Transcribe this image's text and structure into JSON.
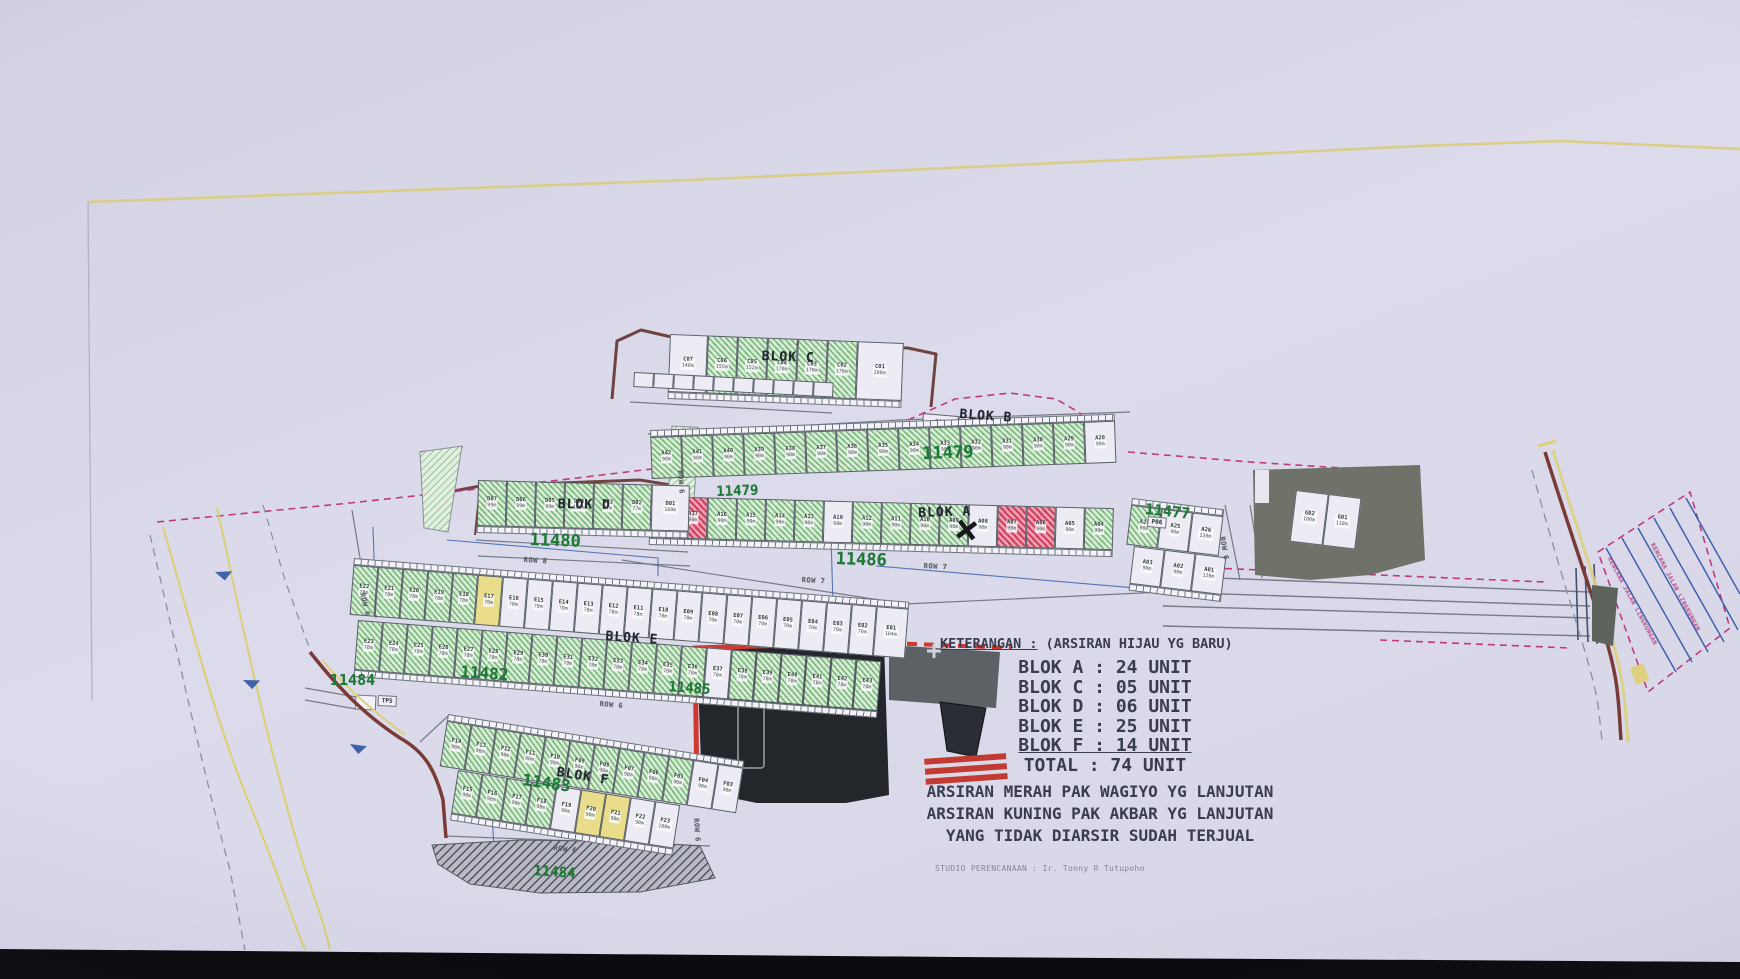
{
  "photo": {
    "paper_color": "#d8d7e8",
    "bottom_bar_color": "#0b0b0e",
    "yellow_line_color": "#d9cd7d",
    "green_hatch_color": "#79b97c",
    "red_hatch_color": "#cf4260",
    "yellow_unit_color": "#e9dd8b",
    "parcel_number_color": "#1c7c35",
    "boundary_magenta": "#c03a80",
    "road_brown": "#7a3b36",
    "blue_line": "#3f63aa",
    "gray_area": "#5e635c"
  },
  "legend": {
    "title_label": "KETERANGAN :",
    "title_note": " (ARSIRAN HIJAU YG BARU)",
    "rows": [
      {
        "label": "BLOK A",
        "value": "24 UNIT",
        "underline": false
      },
      {
        "label": "BLOK C",
        "value": "05 UNIT",
        "underline": false
      },
      {
        "label": "BLOK D",
        "value": "06 UNIT",
        "underline": false
      },
      {
        "label": "BLOK E",
        "value": "25 UNIT",
        "underline": false
      },
      {
        "label": "BLOK F",
        "value": "14 UNIT",
        "underline": true
      },
      {
        "label": "TOTAL",
        "value": "74 UNIT",
        "underline": false
      }
    ],
    "notes": [
      "ARSIRAN MERAH PAK WAGIYO YG LANJUTAN",
      "ARSIRAN KUNING PAK AKBAR YG LANJUTAN",
      "YANG TIDAK DIARSIR SUDAH TERJUAL"
    ],
    "credit": "STUDIO PERENCANAAN : Ir. Tonny R Tutupoho"
  },
  "labels": [
    {
      "text": "11479",
      "x": 922,
      "y": 444,
      "size": 17,
      "rot": -2,
      "cls": "parcel"
    },
    {
      "text": "11479",
      "x": 716,
      "y": 484,
      "size": 14,
      "rot": -2,
      "cls": "parcel"
    },
    {
      "text": "11477",
      "x": 1146,
      "y": 500,
      "size": 15,
      "rot": 6,
      "cls": "parcel"
    },
    {
      "text": "11480",
      "x": 530,
      "y": 530,
      "size": 17,
      "rot": 2,
      "cls": "parcel"
    },
    {
      "text": "11486",
      "x": 836,
      "y": 549,
      "size": 17,
      "rot": 2,
      "cls": "parcel"
    },
    {
      "text": "11482",
      "x": 461,
      "y": 662,
      "size": 16,
      "rot": 4,
      "cls": "parcel"
    },
    {
      "text": "11485",
      "x": 669,
      "y": 679,
      "size": 14,
      "rot": 4,
      "cls": "parcel"
    },
    {
      "text": "11484",
      "x": 330,
      "y": 671,
      "size": 15,
      "rot": 0,
      "cls": "parcel"
    },
    {
      "text": "11483",
      "x": 524,
      "y": 770,
      "size": 16,
      "rot": 8,
      "cls": "parcel"
    },
    {
      "text": "11484",
      "x": 534,
      "y": 863,
      "size": 14,
      "rot": 4,
      "cls": "parcel"
    },
    {
      "text": "BLOK C",
      "x": 762,
      "y": 349,
      "size": 13,
      "rot": 2,
      "cls": "blok"
    },
    {
      "text": "BLOK B",
      "x": 960,
      "y": 407,
      "size": 13,
      "rot": 4,
      "cls": "blok"
    },
    {
      "text": "BLOK A",
      "x": 918,
      "y": 506,
      "size": 13,
      "rot": -2,
      "cls": "blok"
    },
    {
      "text": "BLOK D",
      "x": 558,
      "y": 497,
      "size": 13,
      "rot": 1,
      "cls": "blok"
    },
    {
      "text": "BLOK E",
      "x": 606,
      "y": 629,
      "size": 13,
      "rot": 4,
      "cls": "blok"
    },
    {
      "text": "BLOK F",
      "x": 558,
      "y": 765,
      "size": 13,
      "rot": 9,
      "cls": "blok"
    },
    {
      "text": "ROW 6",
      "x": 684,
      "y": 470,
      "size": 7,
      "rot": 86,
      "cls": "row"
    },
    {
      "text": "ROW 8",
      "x": 524,
      "y": 556,
      "size": 7,
      "rot": 3,
      "cls": "row"
    },
    {
      "text": "ROW 7",
      "x": 802,
      "y": 576,
      "size": 7,
      "rot": 3,
      "cls": "row"
    },
    {
      "text": "ROW 7",
      "x": 924,
      "y": 562,
      "size": 7,
      "rot": 3,
      "cls": "row"
    },
    {
      "text": "ROW 6",
      "x": 1226,
      "y": 536,
      "size": 7,
      "rot": 80,
      "cls": "row"
    },
    {
      "text": "ROW 6",
      "x": 366,
      "y": 592,
      "size": 7,
      "rot": 76,
      "cls": "row"
    },
    {
      "text": "ROW 6",
      "x": 600,
      "y": 700,
      "size": 7,
      "rot": 5,
      "cls": "row"
    },
    {
      "text": "ROW 6",
      "x": 700,
      "y": 818,
      "size": 7,
      "rot": 86,
      "cls": "row"
    },
    {
      "text": "ROW 6",
      "x": 554,
      "y": 844,
      "size": 7,
      "rot": 7,
      "cls": "row"
    },
    {
      "text": "TPS",
      "x": 378,
      "y": 695,
      "size": 6,
      "rot": 3,
      "cls": "tinybox"
    },
    {
      "text": "P06",
      "x": 1148,
      "y": 516,
      "size": 6,
      "rot": 5,
      "cls": "tinybox"
    },
    {
      "text": "RENCANA JALAN LINGKUNGAN",
      "x": 1612,
      "y": 556,
      "size": 6,
      "rot": 62,
      "cls": "magenta"
    },
    {
      "text": "RENCANA JALAN LINGKUNGAN",
      "x": 1655,
      "y": 542,
      "size": 6,
      "rot": 62,
      "cls": "magenta"
    },
    {
      "text": "×",
      "x": 958,
      "y": 505,
      "size": 40,
      "rot": 8,
      "cls": "xmark"
    }
  ],
  "strips": [
    {
      "name": "blok-c",
      "x": 670,
      "y": 334,
      "rot": 2.2,
      "cw": 30,
      "ch": 58,
      "porch": "bottom",
      "cells": [
        {
          "i": "C07",
          "a": "148m",
          "f": "w",
          "w": 38
        },
        {
          "i": "C06",
          "a": "155m",
          "f": "g"
        },
        {
          "i": "C05",
          "a": "152m",
          "f": "g"
        },
        {
          "i": "C04",
          "a": "170m",
          "f": "g"
        },
        {
          "i": "C03",
          "a": "170m",
          "f": "g"
        },
        {
          "i": "C02",
          "a": "170m",
          "f": "g"
        },
        {
          "i": "C01",
          "a": "200m",
          "f": "w",
          "w": 46
        }
      ]
    },
    {
      "name": "c-backrow",
      "x": 634,
      "y": 372,
      "rot": 3,
      "cw": 20,
      "ch": 15,
      "porch": "none",
      "cells": [
        {
          "i": "",
          "f": "w"
        },
        {
          "i": "",
          "f": "w"
        },
        {
          "i": "",
          "f": "w"
        },
        {
          "i": "",
          "f": "w"
        },
        {
          "i": "",
          "f": "w"
        },
        {
          "i": "",
          "f": "w"
        },
        {
          "i": "",
          "f": "w"
        },
        {
          "i": "",
          "f": "w"
        },
        {
          "i": "",
          "f": "w"
        },
        {
          "i": "",
          "f": "w"
        }
      ]
    },
    {
      "name": "blok-b",
      "x": 923,
      "y": 413,
      "rot": 5,
      "cw": 36,
      "ch": 24,
      "porch": "bottom",
      "cells": [
        {
          "i": "B03",
          "a": "143m",
          "f": "w"
        },
        {
          "i": "B02",
          "a": "150m",
          "f": "w"
        },
        {
          "i": "B01",
          "a": "146m",
          "f": "w"
        }
      ]
    },
    {
      "name": "blok-a-upper",
      "x": 650,
      "y": 430,
      "rot": -2,
      "cw": 31,
      "ch": 42,
      "porch": "top",
      "cells": [
        {
          "i": "A42",
          "a": "90m",
          "f": "g"
        },
        {
          "i": "A41",
          "a": "90m",
          "f": "g"
        },
        {
          "i": "A40",
          "a": "90m",
          "f": "g"
        },
        {
          "i": "A39",
          "a": "90m",
          "f": "g"
        },
        {
          "i": "A38",
          "a": "90m",
          "f": "g"
        },
        {
          "i": "A37",
          "a": "90m",
          "f": "g"
        },
        {
          "i": "A36",
          "a": "90m",
          "f": "g"
        },
        {
          "i": "A35",
          "a": "90m",
          "f": "g"
        },
        {
          "i": "A34",
          "a": "90m",
          "f": "g"
        },
        {
          "i": "A33",
          "a": "90m",
          "f": "g"
        },
        {
          "i": "A32",
          "a": "90m",
          "f": "g"
        },
        {
          "i": "A31",
          "a": "90m",
          "f": "g"
        },
        {
          "i": "A30",
          "a": "90m",
          "f": "g"
        },
        {
          "i": "A29",
          "a": "90m",
          "f": "g"
        },
        {
          "i": "A28",
          "a": "90m",
          "f": "w"
        }
      ]
    },
    {
      "name": "blok-a-lower",
      "x": 650,
      "y": 496,
      "rot": 1.5,
      "cw": 29,
      "ch": 42,
      "porch": "bottom",
      "cells": [
        {
          "i": "A18",
          "a": "90m",
          "f": "w"
        },
        {
          "i": "A17",
          "a": "90m",
          "f": "r"
        },
        {
          "i": "A16",
          "a": "90m",
          "f": "g"
        },
        {
          "i": "A15",
          "a": "90m",
          "f": "g"
        },
        {
          "i": "A14",
          "a": "90m",
          "f": "g"
        },
        {
          "i": "A13",
          "a": "90m",
          "f": "g"
        },
        {
          "i": "A19",
          "a": "60m",
          "f": "w"
        },
        {
          "i": "A12",
          "a": "90m",
          "f": "g"
        },
        {
          "i": "A11",
          "a": "90m",
          "f": "g"
        },
        {
          "i": "A10",
          "a": "90m",
          "f": "g"
        },
        {
          "i": "A09",
          "a": "90m",
          "f": "g"
        },
        {
          "i": "A08",
          "a": "90m",
          "f": "w"
        },
        {
          "i": "A07",
          "a": "90m",
          "f": "r"
        },
        {
          "i": "A06",
          "a": "90m",
          "f": "r"
        },
        {
          "i": "A05",
          "a": "90m",
          "f": "w"
        },
        {
          "i": "A04",
          "a": "90m",
          "f": "g"
        }
      ]
    },
    {
      "name": "blok-a-right-upper",
      "x": 1132,
      "y": 498,
      "rot": 7,
      "cw": 31,
      "ch": 40,
      "porch": "top",
      "cells": [
        {
          "i": "A24",
          "a": "90m",
          "f": "g"
        },
        {
          "i": "A25",
          "a": "90m",
          "f": "w"
        },
        {
          "i": "A26",
          "a": "120m",
          "f": "w"
        }
      ]
    },
    {
      "name": "blok-a-right-lower",
      "x": 1134,
      "y": 546,
      "rot": 7,
      "cw": 31,
      "ch": 38,
      "porch": "bottom",
      "cells": [
        {
          "i": "A03",
          "a": "90m",
          "f": "w"
        },
        {
          "i": "A02",
          "a": "90m",
          "f": "w"
        },
        {
          "i": "A01",
          "a": "120m",
          "f": "w"
        }
      ]
    },
    {
      "name": "blok-d",
      "x": 478,
      "y": 480,
      "rot": 1.5,
      "cw": 29,
      "ch": 46,
      "porch": "bottom",
      "cells": [
        {
          "i": "D07",
          "a": "99m",
          "f": "g"
        },
        {
          "i": "D06",
          "a": "99m",
          "f": "g"
        },
        {
          "i": "D05",
          "a": "99m",
          "f": "g"
        },
        {
          "i": "D04",
          "a": "100m",
          "f": "g"
        },
        {
          "i": "D03",
          "a": "77m",
          "f": "g"
        },
        {
          "i": "D02",
          "a": "77m",
          "f": "g"
        },
        {
          "i": "D01",
          "a": "160m",
          "f": "w",
          "w": 38
        }
      ]
    },
    {
      "name": "blok-e-upper",
      "x": 354,
      "y": 558,
      "rot": 4.5,
      "cw": 25,
      "ch": 50,
      "porch": "top",
      "cells": [
        {
          "i": "E22",
          "a": "78m",
          "f": "g"
        },
        {
          "i": "E21",
          "a": "78m",
          "f": "g"
        },
        {
          "i": "E20",
          "a": "78m",
          "f": "g"
        },
        {
          "i": "E19",
          "a": "78m",
          "f": "g"
        },
        {
          "i": "E18",
          "a": "78m",
          "f": "g"
        },
        {
          "i": "E17",
          "a": "78m",
          "f": "y"
        },
        {
          "i": "E16",
          "a": "78m",
          "f": "w"
        },
        {
          "i": "E15",
          "a": "78m",
          "f": "w"
        },
        {
          "i": "E14",
          "a": "78m",
          "f": "w"
        },
        {
          "i": "E13",
          "a": "78m",
          "f": "w"
        },
        {
          "i": "E12",
          "a": "78m",
          "f": "w"
        },
        {
          "i": "E11",
          "a": "78m",
          "f": "w"
        },
        {
          "i": "E10",
          "a": "70m",
          "f": "w"
        },
        {
          "i": "E09",
          "a": "70m",
          "f": "w"
        },
        {
          "i": "E08",
          "a": "70m",
          "f": "w"
        },
        {
          "i": "E07",
          "a": "70m",
          "f": "w"
        },
        {
          "i": "E06",
          "a": "70m",
          "f": "w"
        },
        {
          "i": "E05",
          "a": "70m",
          "f": "w"
        },
        {
          "i": "E04",
          "a": "70m",
          "f": "w"
        },
        {
          "i": "E03",
          "a": "70m",
          "f": "w"
        },
        {
          "i": "E02",
          "a": "70m",
          "f": "w"
        },
        {
          "i": "E01",
          "a": "104m",
          "f": "w",
          "w": 32
        }
      ]
    },
    {
      "name": "blok-e-lower",
      "x": 358,
      "y": 620,
      "rot": 4.5,
      "cw": 25,
      "ch": 50,
      "porch": "bottom",
      "cells": [
        {
          "i": "E23",
          "a": "78m",
          "f": "g"
        },
        {
          "i": "E24",
          "a": "78m",
          "f": "g"
        },
        {
          "i": "E25",
          "a": "78m",
          "f": "g"
        },
        {
          "i": "E26",
          "a": "78m",
          "f": "g"
        },
        {
          "i": "E27",
          "a": "78m",
          "f": "g"
        },
        {
          "i": "E28",
          "a": "78m",
          "f": "g"
        },
        {
          "i": "E29",
          "a": "78m",
          "f": "g"
        },
        {
          "i": "E30",
          "a": "78m",
          "f": "g"
        },
        {
          "i": "E31",
          "a": "78m",
          "f": "g"
        },
        {
          "i": "E32",
          "a": "78m",
          "f": "g"
        },
        {
          "i": "E33",
          "a": "78m",
          "f": "g"
        },
        {
          "i": "E34",
          "a": "78m",
          "f": "g"
        },
        {
          "i": "E35",
          "a": "78m",
          "f": "g"
        },
        {
          "i": "E36",
          "a": "78m",
          "f": "g"
        },
        {
          "i": "E37",
          "a": "78m",
          "f": "w"
        },
        {
          "i": "E38",
          "a": "78m",
          "f": "g"
        },
        {
          "i": "E39",
          "a": "78m",
          "f": "g"
        },
        {
          "i": "E40",
          "a": "78m",
          "f": "g"
        },
        {
          "i": "E41",
          "a": "78m",
          "f": "g"
        },
        {
          "i": "E42",
          "a": "78m",
          "f": "g"
        },
        {
          "i": "E43",
          "a": "78m",
          "f": "g"
        }
      ]
    },
    {
      "name": "blok-f-upper",
      "x": 448,
      "y": 714,
      "rot": 9,
      "cw": 25,
      "ch": 46,
      "porch": "top",
      "cells": [
        {
          "i": "F14",
          "a": "90m",
          "f": "g"
        },
        {
          "i": "F13",
          "a": "90m",
          "f": "g"
        },
        {
          "i": "F12",
          "a": "90m",
          "f": "g"
        },
        {
          "i": "F11",
          "a": "90m",
          "f": "g"
        },
        {
          "i": "F10",
          "a": "90m",
          "f": "g"
        },
        {
          "i": "F09",
          "a": "90m",
          "f": "g"
        },
        {
          "i": "F08",
          "a": "90m",
          "f": "g"
        },
        {
          "i": "F07",
          "a": "90m",
          "f": "g"
        },
        {
          "i": "F06",
          "a": "90m",
          "f": "g"
        },
        {
          "i": "F05",
          "a": "90m",
          "f": "g"
        },
        {
          "i": "F04",
          "a": "90m",
          "f": "w"
        },
        {
          "i": "F03",
          "a": "90m",
          "f": "w"
        }
      ]
    },
    {
      "name": "blok-f-lower",
      "x": 458,
      "y": 770,
      "rot": 9,
      "cw": 25,
      "ch": 44,
      "porch": "bottom",
      "cells": [
        {
          "i": "F15",
          "a": "90m",
          "f": "g"
        },
        {
          "i": "F16",
          "a": "90m",
          "f": "g"
        },
        {
          "i": "F17",
          "a": "90m",
          "f": "g"
        },
        {
          "i": "F18",
          "a": "90m",
          "f": "g"
        },
        {
          "i": "F19",
          "a": "90m",
          "f": "w"
        },
        {
          "i": "F20",
          "a": "90m",
          "f": "y"
        },
        {
          "i": "F21",
          "a": "90m",
          "f": "y"
        },
        {
          "i": "F22",
          "a": "90m",
          "f": "w"
        },
        {
          "i": "F23",
          "a": "100m",
          "f": "w"
        }
      ]
    },
    {
      "name": "g-units",
      "x": 1296,
      "y": 490,
      "rot": 7,
      "cw": 33,
      "ch": 52,
      "porch": "none",
      "cells": [
        {
          "i": "G02",
          "a": "100m",
          "f": "w"
        },
        {
          "i": "G01",
          "a": "118m",
          "f": "w"
        }
      ]
    }
  ]
}
